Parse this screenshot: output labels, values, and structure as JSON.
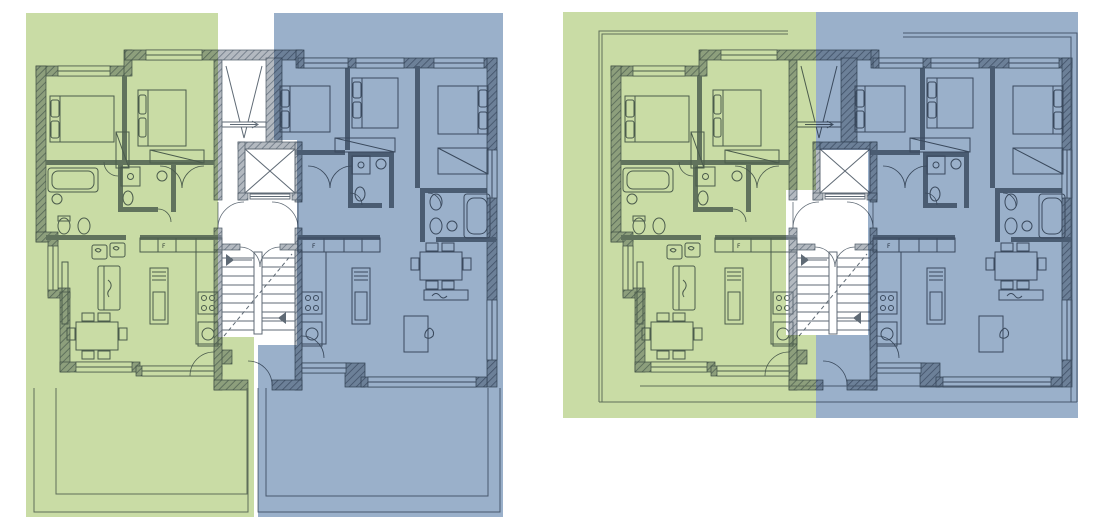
{
  "page": {
    "background": "#ffffff",
    "description": "Two residential floor plans with unit color overlays"
  },
  "colors": {
    "unit_green": "#c9dca5",
    "unit_blue": "#9ab0ca",
    "wall_line": "#4e5a66",
    "thin_line": "#778089"
  },
  "labels": {
    "fridge": "F"
  },
  "plans": {
    "left": {
      "id": "floor-plan-left",
      "green_points": "26,13 218,13 218,337 254,337 254,517 26,517",
      "blue_points": "274,13 503,13 503,517 258,517 258,345 297,345 297,140 274,140",
      "terrace_outer_green": "M34,388 L34,512 L248,512 L248,388",
      "terrace_inner_green": "M56,388 L56,494 L247,494 L247,388",
      "terrace_outer_blue": "M258,388 L258,512 L500,512 L500,388",
      "terrace_inner_blue": "M266,388 L266,496 L488,496 L488,388"
    },
    "right": {
      "id": "floor-plan-right",
      "green_points": "563,12 816,12 816,190 786,190 786,335 816,335 816,418 563,418",
      "blue_points": "816,12 1078,12 1078,418 816,418 816,335 868,335 868,150 816,150",
      "outline_left_a": "M599,402 L599,31 L788,31",
      "outline_left_b": "M602,402 L602,34 L788,34",
      "outline_right_a": "M903,33 L1077,33 L1077,402",
      "outline_right_b": "M903,37 L1071,37 L1071,402",
      "outline_bottom_a": "M599,402 L1077,402",
      "outline_bottom_b": "M640,386 L1062,386"
    }
  }
}
